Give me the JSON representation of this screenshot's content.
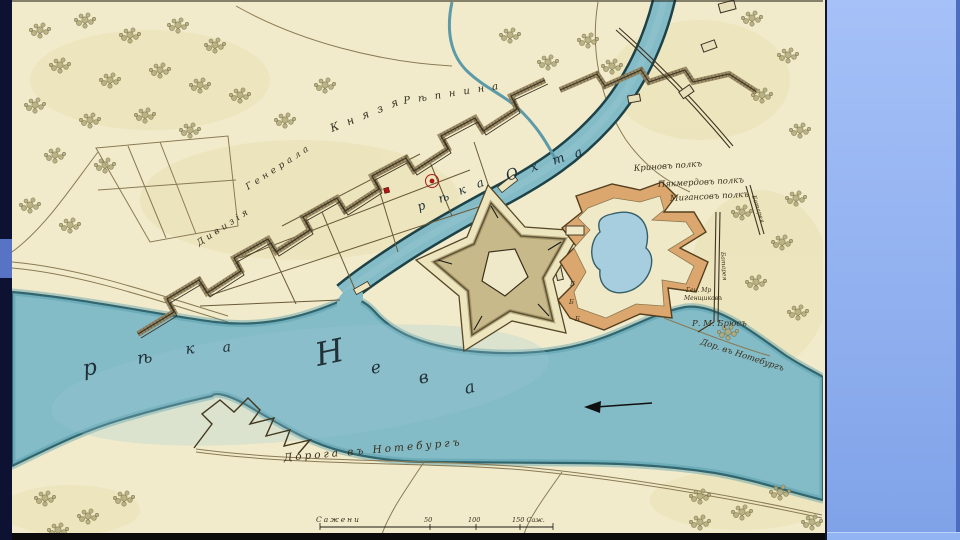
{
  "slide": {
    "left_bar": {
      "color": "#0d1233",
      "accent_color": "#5873c6"
    },
    "right_panel": {
      "top_color": "#a6c1f8",
      "bottom_color": "#7fa2e8",
      "edge_color": "#4c6cc0",
      "footer_color": "#93b4f2"
    },
    "frame_color": "#0b0b0b"
  },
  "map": {
    "colors": {
      "paper": "#f1ebcb",
      "water": "#83bbc7",
      "water_edge": "#1d4247",
      "water_band": "#4e98a8",
      "rampart_tan": "#c8b98a",
      "hornwork_orange": "#dba76e",
      "pond": "#a6cede",
      "red_marker": "#b01818",
      "ink": "#3c3424"
    },
    "labels": {
      "river_neva_letters": [
        "р",
        "ѣ",
        "к",
        "а",
        "Н",
        "е",
        "в",
        "а"
      ],
      "river_okhta_letters": [
        "р",
        "ѣ",
        "к",
        "а",
        "О",
        "х",
        "т",
        "а"
      ],
      "division_words": [
        "Дивизія",
        "Генерала",
        "Князя",
        "Рѣпнина"
      ],
      "regiments": [
        "Криновъ полкъ",
        "Пякмердовъ полкъ",
        "Мигансовъ полкъ"
      ],
      "commander_lines": [
        "Ген. Мр",
        "Менщиковъ"
      ],
      "bruce": "Р. М. Брюсъ",
      "road_small": "Дор. въ Нотебургъ",
      "road_main": "Дорога въ Нотебургъ",
      "batteries": [
        "Батарея",
        "Батарея"
      ],
      "letter_markers": [
        "Б",
        "Б",
        "Б"
      ],
      "scale": {
        "label": "Сажени",
        "ticks": [
          "50",
          "100",
          "150 Саж."
        ]
      }
    },
    "tree_clusters": [
      [
        40,
        30
      ],
      [
        85,
        20
      ],
      [
        130,
        35
      ],
      [
        178,
        25
      ],
      [
        215,
        45
      ],
      [
        60,
        65
      ],
      [
        110,
        80
      ],
      [
        160,
        70
      ],
      [
        200,
        85
      ],
      [
        35,
        105
      ],
      [
        90,
        120
      ],
      [
        145,
        115
      ],
      [
        190,
        130
      ],
      [
        55,
        155
      ],
      [
        105,
        165
      ],
      [
        30,
        205
      ],
      [
        70,
        225
      ],
      [
        240,
        95
      ],
      [
        285,
        120
      ],
      [
        325,
        85
      ],
      [
        510,
        35
      ],
      [
        548,
        62
      ],
      [
        588,
        40
      ],
      [
        612,
        66
      ],
      [
        752,
        18
      ],
      [
        788,
        55
      ],
      [
        762,
        95
      ],
      [
        800,
        130
      ],
      [
        742,
        212
      ],
      [
        782,
        242
      ],
      [
        756,
        282
      ],
      [
        798,
        312
      ],
      [
        728,
        332
      ],
      [
        796,
        198
      ],
      [
        700,
        496
      ],
      [
        742,
        512
      ],
      [
        780,
        492
      ],
      [
        812,
        522
      ],
      [
        700,
        522
      ],
      [
        45,
        498
      ],
      [
        88,
        516
      ],
      [
        124,
        498
      ],
      [
        58,
        530
      ]
    ]
  }
}
